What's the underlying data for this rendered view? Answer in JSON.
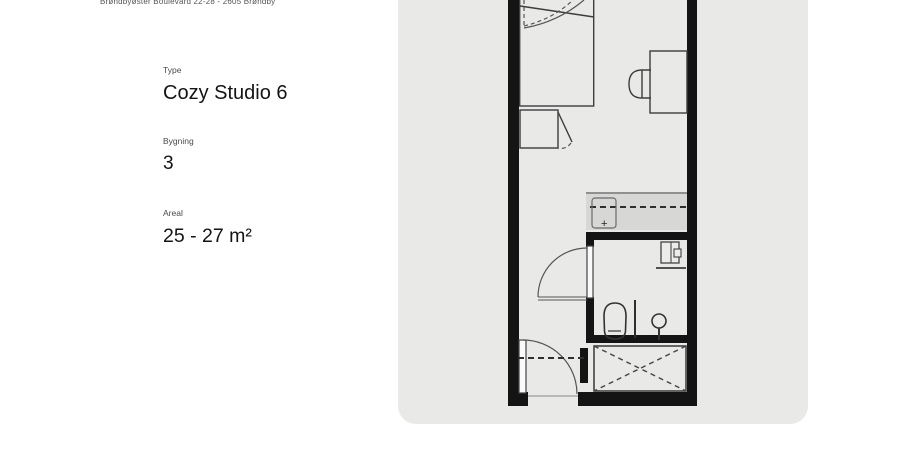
{
  "listing": {
    "address": "Brøndbyøster Boulevard 22-28 - 2605 Brøndby",
    "fields": [
      {
        "label": "Type",
        "value": "Cozy Studio 6"
      },
      {
        "label": "Bygning",
        "value": "3"
      },
      {
        "label": "Areal",
        "value": "25 - 27 m²"
      }
    ]
  },
  "floorplan": {
    "kitchen_marker": "+",
    "card_color": "#e9e9e7",
    "wall_color": "#141414",
    "counter_color": "#d7d7d5",
    "line_color": "#3d3d3d"
  }
}
